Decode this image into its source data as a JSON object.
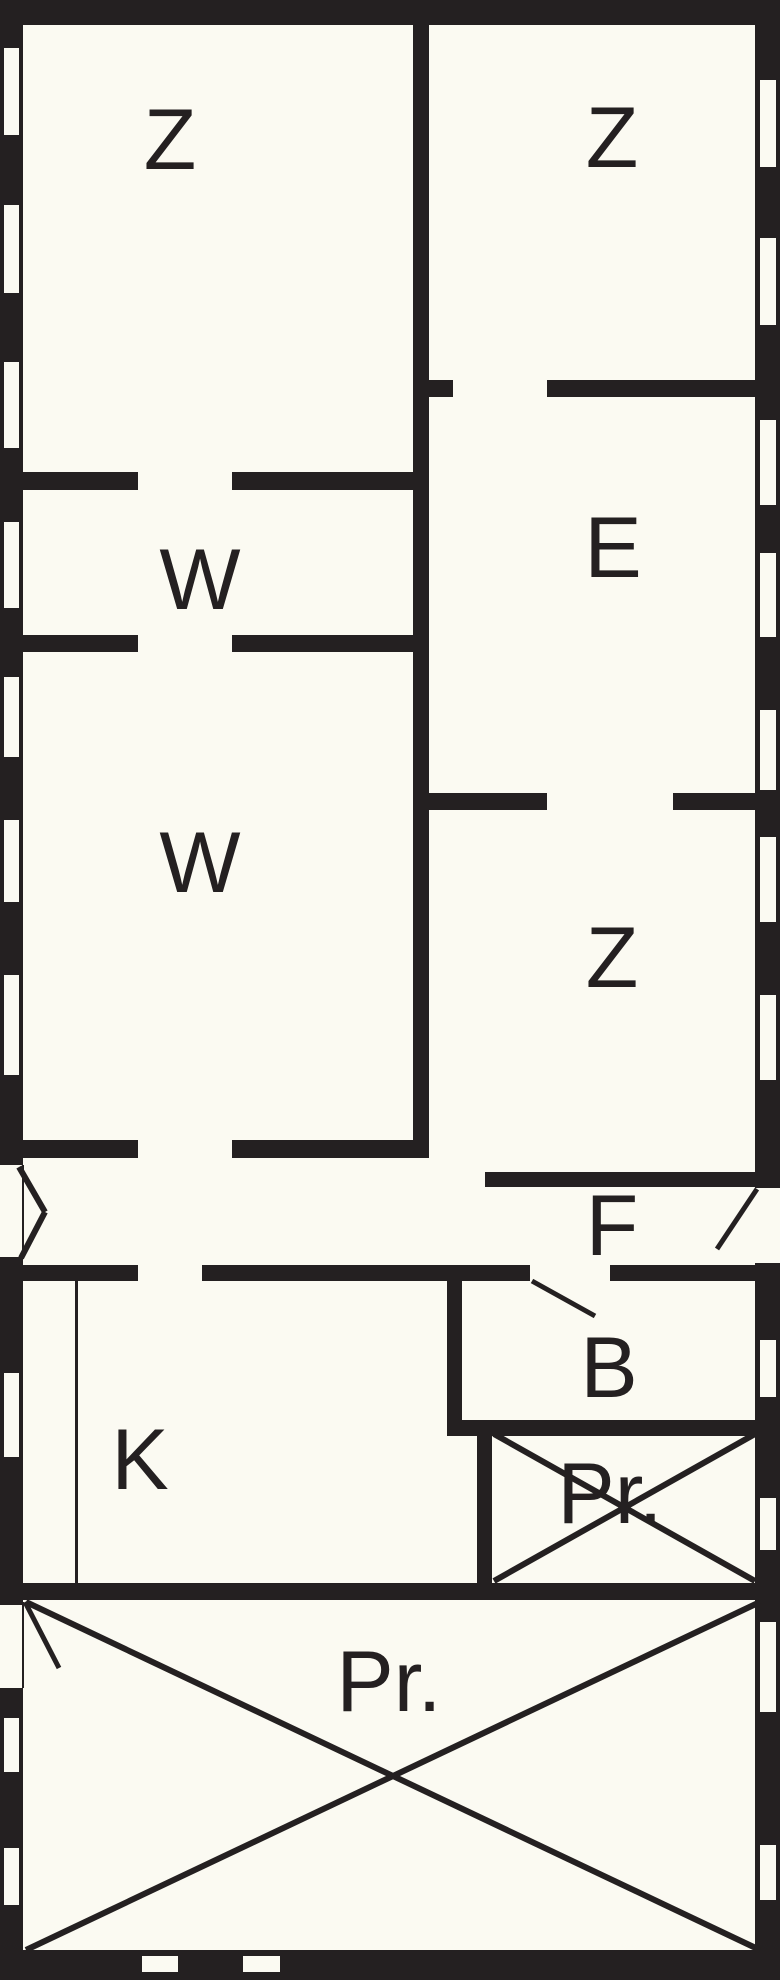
{
  "canvas": {
    "width": 780,
    "height": 1980,
    "background": "#fbfaf2",
    "wall_color": "#242021",
    "label_color": "#242021",
    "label_font_size": 86
  },
  "rooms": [
    {
      "id": "z1",
      "label": "Z",
      "x": 170,
      "y": 140
    },
    {
      "id": "z2",
      "label": "Z",
      "x": 612,
      "y": 138
    },
    {
      "id": "e",
      "label": "E",
      "x": 613,
      "y": 548
    },
    {
      "id": "w1",
      "label": "W",
      "x": 200,
      "y": 580
    },
    {
      "id": "w2",
      "label": "W",
      "x": 200,
      "y": 863
    },
    {
      "id": "z3",
      "label": "Z",
      "x": 612,
      "y": 958
    },
    {
      "id": "f",
      "label": "F",
      "x": 612,
      "y": 1226
    },
    {
      "id": "b",
      "label": "B",
      "x": 609,
      "y": 1368
    },
    {
      "id": "pr-small",
      "label": "Pr.",
      "x": 610,
      "y": 1494
    },
    {
      "id": "k",
      "label": "K",
      "x": 140,
      "y": 1460
    },
    {
      "id": "pr-large",
      "label": "Pr.",
      "x": 389,
      "y": 1682
    }
  ],
  "walls": [
    {
      "name": "outer-wall-top",
      "x": 0,
      "y": 0,
      "w": 780,
      "h": 25
    },
    {
      "name": "outer-wall-left-upper",
      "x": 0,
      "y": 0,
      "w": 23,
      "h": 1165
    },
    {
      "name": "outer-wall-left-middle",
      "x": 0,
      "y": 1257,
      "w": 23,
      "h": 348
    },
    {
      "name": "outer-wall-left-lower",
      "x": 0,
      "y": 1688,
      "w": 23,
      "h": 292
    },
    {
      "name": "outer-wall-right-upper",
      "x": 755,
      "y": 0,
      "w": 25,
      "h": 1188
    },
    {
      "name": "outer-wall-right-lower",
      "x": 755,
      "y": 1263,
      "w": 25,
      "h": 717
    },
    {
      "name": "outer-wall-bottom",
      "x": 0,
      "y": 1950,
      "w": 780,
      "h": 30
    },
    {
      "name": "wall-z1-z2-divider",
      "x": 413,
      "y": 23,
      "w": 16,
      "h": 1135
    },
    {
      "name": "wall-z1-bottom-left",
      "x": 23,
      "y": 472,
      "w": 115,
      "h": 18
    },
    {
      "name": "wall-z1-bottom-right",
      "x": 232,
      "y": 472,
      "w": 181,
      "h": 18
    },
    {
      "name": "wall-z2-bottom-stub",
      "x": 429,
      "y": 380,
      "w": 24,
      "h": 17
    },
    {
      "name": "wall-z2-bottom-right",
      "x": 547,
      "y": 380,
      "w": 210,
      "h": 17
    },
    {
      "name": "wall-w1-bottom-left",
      "x": 23,
      "y": 635,
      "w": 115,
      "h": 17
    },
    {
      "name": "wall-w1-bottom-right",
      "x": 232,
      "y": 635,
      "w": 181,
      "h": 17
    },
    {
      "name": "wall-e-bottom-left",
      "x": 429,
      "y": 793,
      "w": 118,
      "h": 17
    },
    {
      "name": "wall-e-bottom-right",
      "x": 673,
      "y": 793,
      "w": 84,
      "h": 17
    },
    {
      "name": "wall-w2-bottom-left",
      "x": 23,
      "y": 1140,
      "w": 115,
      "h": 18
    },
    {
      "name": "wall-w2-bottom-right",
      "x": 232,
      "y": 1140,
      "w": 197,
      "h": 18
    },
    {
      "name": "wall-z3-bottom",
      "x": 485,
      "y": 1172,
      "w": 272,
      "h": 15
    },
    {
      "name": "wall-hall-bottom-left",
      "x": 18,
      "y": 1265,
      "w": 120,
      "h": 16
    },
    {
      "name": "wall-hall-bottom-mid",
      "x": 202,
      "y": 1265,
      "w": 328,
      "h": 16
    },
    {
      "name": "wall-hall-bottom-right",
      "x": 610,
      "y": 1265,
      "w": 147,
      "h": 16
    },
    {
      "name": "wall-b-left",
      "x": 447,
      "y": 1265,
      "w": 15,
      "h": 171
    },
    {
      "name": "wall-b-bottom",
      "x": 447,
      "y": 1420,
      "w": 310,
      "h": 16
    },
    {
      "name": "wall-pr-small-left",
      "x": 477,
      "y": 1420,
      "w": 15,
      "h": 180
    },
    {
      "name": "wall-k-bottom",
      "x": 23,
      "y": 1583,
      "w": 757,
      "h": 17
    }
  ],
  "windows": [
    {
      "name": "window-left-1",
      "x": 4,
      "y": 48,
      "w": 15,
      "h": 87
    },
    {
      "name": "window-left-2",
      "x": 4,
      "y": 205,
      "w": 15,
      "h": 88
    },
    {
      "name": "window-left-3",
      "x": 4,
      "y": 362,
      "w": 15,
      "h": 86
    },
    {
      "name": "window-left-4",
      "x": 4,
      "y": 522,
      "w": 15,
      "h": 86
    },
    {
      "name": "window-left-5",
      "x": 4,
      "y": 677,
      "w": 15,
      "h": 80
    },
    {
      "name": "window-left-6",
      "x": 4,
      "y": 820,
      "w": 15,
      "h": 82
    },
    {
      "name": "window-left-7",
      "x": 4,
      "y": 975,
      "w": 15,
      "h": 100
    },
    {
      "name": "window-left-8",
      "x": 4,
      "y": 1373,
      "w": 15,
      "h": 84
    },
    {
      "name": "window-left-9",
      "x": 4,
      "y": 1718,
      "w": 15,
      "h": 54
    },
    {
      "name": "window-left-10",
      "x": 4,
      "y": 1848,
      "w": 15,
      "h": 57
    },
    {
      "name": "window-right-1",
      "x": 760,
      "y": 80,
      "w": 16,
      "h": 87
    },
    {
      "name": "window-right-2",
      "x": 760,
      "y": 238,
      "w": 16,
      "h": 87
    },
    {
      "name": "window-right-3",
      "x": 760,
      "y": 420,
      "w": 16,
      "h": 85
    },
    {
      "name": "window-right-4",
      "x": 760,
      "y": 553,
      "w": 16,
      "h": 84
    },
    {
      "name": "window-right-5",
      "x": 760,
      "y": 710,
      "w": 16,
      "h": 80
    },
    {
      "name": "window-right-6",
      "x": 760,
      "y": 837,
      "w": 16,
      "h": 85
    },
    {
      "name": "window-right-7",
      "x": 760,
      "y": 995,
      "w": 16,
      "h": 85
    },
    {
      "name": "window-right-8",
      "x": 760,
      "y": 1340,
      "w": 16,
      "h": 57
    },
    {
      "name": "window-right-9",
      "x": 760,
      "y": 1498,
      "w": 16,
      "h": 52
    },
    {
      "name": "window-right-10",
      "x": 760,
      "y": 1622,
      "w": 16,
      "h": 90
    },
    {
      "name": "window-right-11",
      "x": 760,
      "y": 1845,
      "w": 16,
      "h": 55
    },
    {
      "name": "window-bottom-1",
      "x": 142,
      "y": 1956,
      "w": 36,
      "h": 16
    },
    {
      "name": "window-bottom-2",
      "x": 243,
      "y": 1956,
      "w": 37,
      "h": 16
    }
  ],
  "thin_lines": [
    {
      "name": "kitchen-divider-line",
      "x": 75,
      "y": 1281,
      "w": 3,
      "h": 302
    },
    {
      "name": "entry-opening-line",
      "x": 22,
      "y": 1165,
      "w": 2,
      "h": 93
    },
    {
      "name": "pr-door-opening-line",
      "x": 22,
      "y": 1602,
      "w": 2,
      "h": 86
    }
  ],
  "diagonals": [
    {
      "name": "entry-door-swing-upper",
      "x1": 19,
      "y1": 1167,
      "x2": 45,
      "y2": 1212,
      "w": 6
    },
    {
      "name": "entry-door-swing-lower",
      "x1": 45,
      "y1": 1212,
      "x2": 21,
      "y2": 1258,
      "w": 6
    },
    {
      "name": "right-door-swing",
      "x1": 757,
      "y1": 1189,
      "x2": 717,
      "y2": 1249,
      "w": 5
    },
    {
      "name": "b-door-swing",
      "x1": 532,
      "y1": 1281,
      "x2": 595,
      "y2": 1316,
      "w": 5
    },
    {
      "name": "pr-large-door-swing",
      "x1": 25,
      "y1": 1602,
      "x2": 59,
      "y2": 1668,
      "w": 5
    },
    {
      "name": "pr-small-cross-1",
      "x1": 494,
      "y1": 1434,
      "x2": 755,
      "y2": 1581,
      "w": 6
    },
    {
      "name": "pr-small-cross-2",
      "x1": 755,
      "y1": 1434,
      "x2": 494,
      "y2": 1581,
      "w": 6
    },
    {
      "name": "pr-large-cross-1",
      "x1": 26,
      "y1": 1602,
      "x2": 760,
      "y2": 1950,
      "w": 6
    },
    {
      "name": "pr-large-cross-2",
      "x1": 760,
      "y1": 1602,
      "x2": 26,
      "y2": 1950,
      "w": 6
    }
  ]
}
